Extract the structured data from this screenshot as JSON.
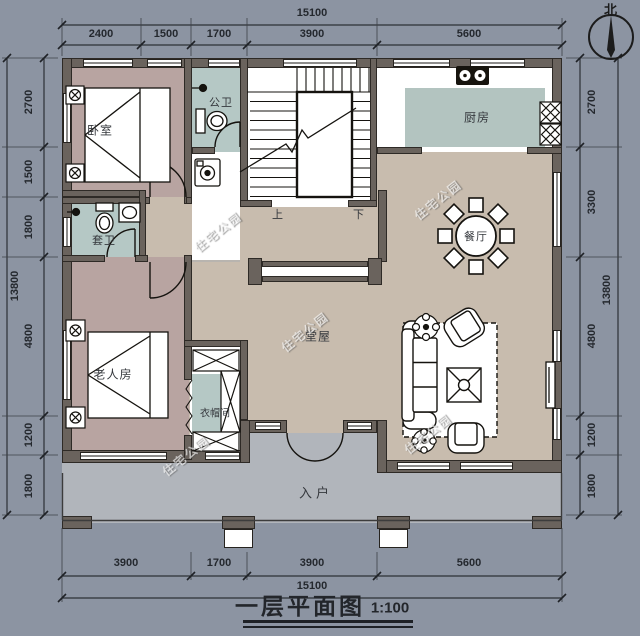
{
  "title": {
    "text": "一层平面图",
    "scale": "1:100"
  },
  "compass": {
    "label": "北"
  },
  "watermark": {
    "text": "住宅公园"
  },
  "rooms": {
    "bedroom": "卧室",
    "public_bath": "公卫",
    "kitchen": "厨房",
    "ensuite_bath": "套卫",
    "dining": "餐厅",
    "hall": "堂屋",
    "elder_room": "老人房",
    "cloakroom": "衣帽间",
    "entry": "入户"
  },
  "stairs": {
    "up": "上",
    "down": "下"
  },
  "dims": {
    "top_overall": "15100",
    "top": [
      "2400",
      "1500",
      "1700",
      "3900",
      "5600"
    ],
    "bottom": [
      "3900",
      "1700",
      "3900",
      "5600"
    ],
    "bottom_overall": "15100",
    "left": [
      "2700",
      "1500",
      "1800",
      "4800",
      "1200",
      "1800"
    ],
    "left_overall": "13800",
    "right": [
      "2700",
      "3300",
      "4800",
      "1200",
      "1800"
    ],
    "right_overall": "13800"
  },
  "colors": {
    "background": "#8c94a2",
    "wall": "#6a635d",
    "hall_floor": "#c8bcae",
    "bedroom_floor": "#b8a4a1",
    "bath_floor": "#b5c8c5",
    "porch": "#b1b5bb",
    "ink": "#15130f"
  }
}
